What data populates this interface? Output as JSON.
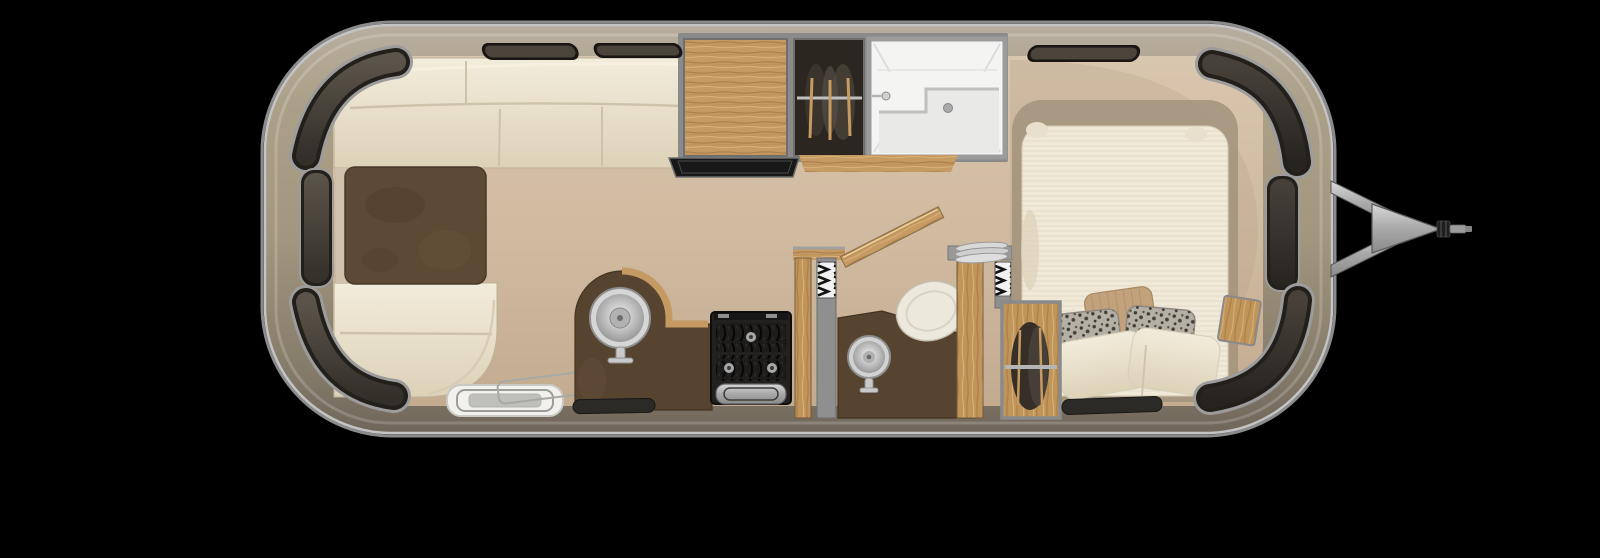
{
  "meta": {
    "view": "top-down travel-trailer floor plan render",
    "background": "#000000"
  },
  "colors": {
    "shell_rim": "#bdbdbd",
    "shell_top": "#b5ab99",
    "shell_mid": "#a3987f",
    "shell_bottom": "#756b5b",
    "floor_light": "#d9c6ae",
    "floor_dark": "#c3ab90",
    "upholstery": "#f0e9d8",
    "table_wood": "#5d4a34",
    "counter_wood": "#564431",
    "oak": "#c59a63",
    "window_glass": "#4a443b",
    "window_frame": "#23201c",
    "shower_white": "#f4f4f2",
    "toilet_white": "#ece8dc",
    "appliance_black": "#23211f",
    "metal_silver": "#c9c9c9",
    "metal_gray": "#8f8f8f",
    "mat_black": "#2c2a27",
    "pillow_tan": "#c2a27c",
    "pillow_leopard": "#b5b0a5",
    "wall_gray": "#8f8f8f"
  },
  "inventory": {
    "front_dinette": [
      "wrap-around-sofa",
      "dinette-table",
      "bench-seat"
    ],
    "galley": [
      "kitchen-sink",
      "two-burner-stove",
      "flip-counter",
      "pantry",
      "hanging-wardrobe",
      "entry-step",
      "floor-mat"
    ],
    "bathroom": [
      "shower-stall",
      "toilet",
      "vanity-sink",
      "swing-door",
      "accordion-door",
      "accordion-door",
      "towel-stack"
    ],
    "bedroom": [
      "bed",
      "pillow-tan",
      "pillow-leopard",
      "pillow-leopard",
      "pillow-white",
      "pillow-white",
      "hanging-closet",
      "corner-nightstand",
      "floor-mat"
    ],
    "exterior": [
      "curved-window-front-top",
      "side-window-front",
      "curved-window-front-bottom",
      "slit-window-1",
      "slit-window-2",
      "slit-window-3",
      "curved-window-rear-top",
      "side-window-rear",
      "curved-window-rear-bottom",
      "a-frame-hitch",
      "coupler"
    ]
  },
  "counts": {
    "windows": 9,
    "accordion_doors": 2,
    "sinks": 2,
    "pillows": 5
  }
}
